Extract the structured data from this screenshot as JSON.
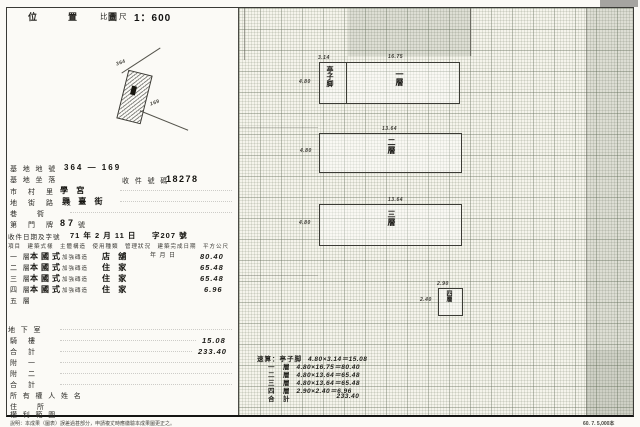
{
  "header": {
    "title": "位　置　圖",
    "scale_label": "比例尺",
    "scale_value": "1：600"
  },
  "sketch": {
    "lot_labels": [
      "364",
      "169"
    ]
  },
  "form": {
    "site_no": {
      "label": "基 地 地 號",
      "value": "364 — 169"
    },
    "site_loc": {
      "label": "基 地 坐 落"
    },
    "receipt": {
      "label": "收 件 號 碼",
      "value": "18278"
    },
    "village": {
      "label": "市　村　里",
      "value": "學 宮"
    },
    "street": {
      "label": "地　街　路　段",
      "value": "興 臺 街"
    },
    "lane": {
      "label": "巷　　衖"
    },
    "house": {
      "label": "第　門　牌",
      "value": "87",
      "suffix": "號"
    },
    "date": {
      "label": "收件日期及字號",
      "value": "71 年 2 月 11 日",
      "number": "字207 號"
    }
  },
  "floors": {
    "header": "項目　建築式樣　主體構造　使用種類　管理狀況　建築完成日期　平方公尺",
    "unit_note": "年 月 日",
    "rows": [
      {
        "name": "一 層",
        "style": "本國式",
        "structure": "加強磚造",
        "use": "店 舖",
        "area": "80.40"
      },
      {
        "name": "二 層",
        "style": "本國式",
        "structure": "加強磚造",
        "use": "住 家",
        "area": "65.48"
      },
      {
        "name": "三 層",
        "style": "本國式",
        "structure": "加強磚造",
        "use": "住 家",
        "area": "65.48"
      },
      {
        "name": "四 層",
        "style": "本國式",
        "structure": "加強磚造",
        "use": "住 家",
        "area": "6.96"
      },
      {
        "name": "五 層",
        "style": "",
        "structure": "",
        "use": "",
        "area": ""
      }
    ],
    "extra_rows": [
      {
        "label": "地 下 室",
        "value": ""
      },
      {
        "label": "騎　樓",
        "value": "15.08"
      },
      {
        "label": "合　計",
        "value": "233.40"
      },
      {
        "label": "附　一",
        "value": ""
      },
      {
        "label": "附　二",
        "value": ""
      },
      {
        "label": "合　計",
        "value": ""
      },
      {
        "label": "所 有 權 人 姓 名",
        "value": ""
      },
      {
        "label": "住　　所",
        "value": ""
      },
      {
        "label": "權 利 範 圍",
        "value": ""
      }
    ]
  },
  "plans": [
    {
      "label": "一層",
      "arcade_label": "亭子脚",
      "dim_top_left": "3.14",
      "dim_top": "16.75",
      "dim_left": "4.80"
    },
    {
      "label": "二層",
      "dim_top": "13.64",
      "dim_left": "4.80"
    },
    {
      "label": "三層",
      "dim_top": "13.64",
      "dim_left": "4.80"
    },
    {
      "label": "四層",
      "dim_top": "2.90",
      "dim_left": "2.40"
    }
  ],
  "calc": {
    "rows": [
      {
        "label": "速算：亭子脚",
        "expr": "4.80×3.14＝15.08"
      },
      {
        "label": "一　層",
        "expr": "4.80×16.75＝80.40"
      },
      {
        "label": "二　層",
        "expr": "4.80×13.64＝65.48"
      },
      {
        "label": "三　層",
        "expr": "4.80×13.64＝65.48"
      },
      {
        "label": "四　層",
        "expr": "2.90×2.40＝6.96"
      },
      {
        "label": "合　計",
        "expr": "233.40"
      }
    ]
  },
  "footer": {
    "note": "說明：本成果（圖表）誤差過甚部分，申請複丈時應繳驗本成果圖更正之。",
    "print_code": "60. 7. 5,000本"
  }
}
